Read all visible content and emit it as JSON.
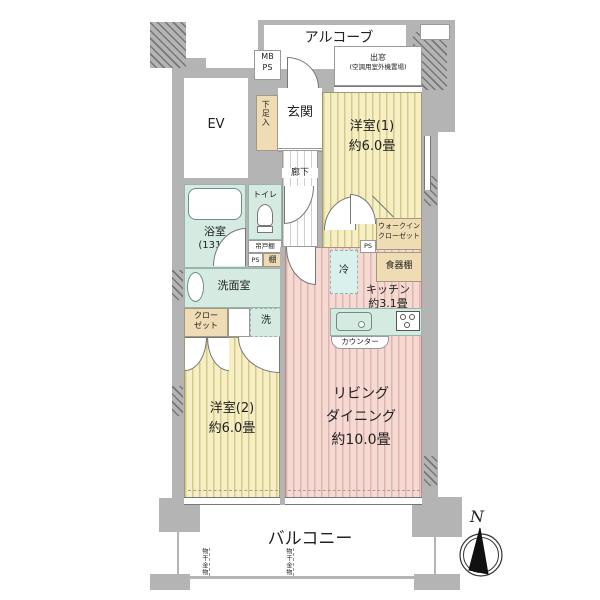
{
  "title": "apartment-floor-plan",
  "colors": {
    "wall": "#b4b4b4",
    "floor_wood_yellow": "#f5efc3",
    "floor_wood_pink": "#f5dad4",
    "wet_area_mint": "#d5ebe2",
    "storage_tan": "#efdcb4",
    "needle_black": "#111111"
  },
  "labels": {
    "alcove": "アルコーブ",
    "mb": "MB",
    "ps": "PS",
    "bay": "出窓",
    "bay_note": "(空調用室外機置場)",
    "ev": "EV",
    "genkan": "玄関",
    "shoe": "下足入",
    "room1": "洋室(1)",
    "room1_size": "約6.0畳",
    "corridor": "廊下",
    "toilet": "トイレ",
    "bath": "浴室",
    "bath_size": "(1317)",
    "hanging_shelf": "吊戸棚",
    "ps_small": "PS",
    "shelf": "棚",
    "wic_line1": "ウォークイン",
    "wic_line2": "クローゼット",
    "ps2": "PS",
    "fridge": "冷",
    "cupboard": "食器棚",
    "kitchen": "キッチン",
    "kitchen_size": "約3.1畳",
    "washroom": "洗面室",
    "washer": "洗",
    "closet_line1": "クロー",
    "closet_line2": "ゼット",
    "counter": "カウンター",
    "room2": "洋室(2)",
    "room2_size": "約6.0畳",
    "ld_line1": "リビング",
    "ld_line2": "ダイニング",
    "ld_line3": "約10.0畳",
    "balcony": "バルコニー",
    "laundry": "物干金物",
    "north": "N"
  }
}
